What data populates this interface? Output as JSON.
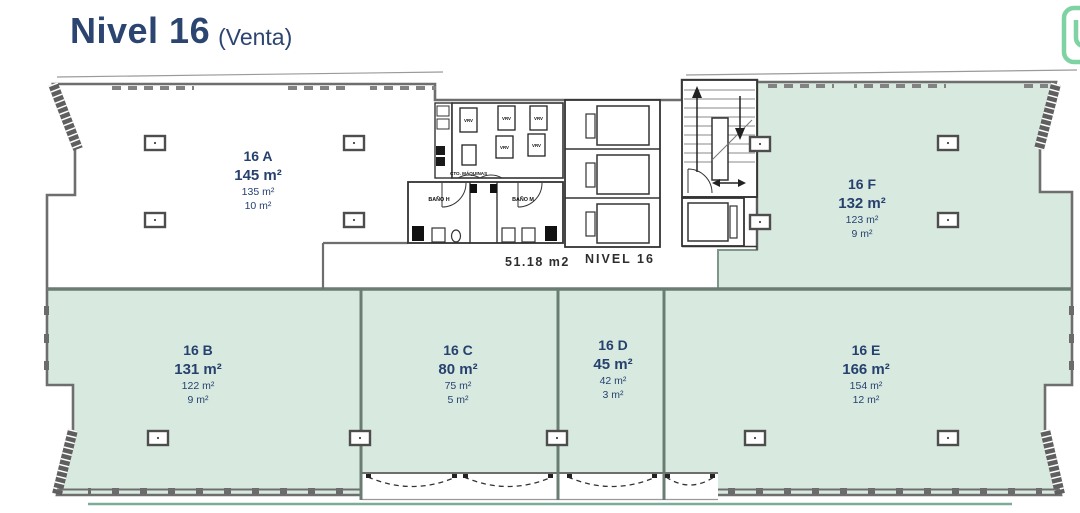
{
  "title": {
    "main": "Nivel 16",
    "suffix": "(Venta)"
  },
  "corridor": {
    "area": "51.18 m2",
    "level": "NIVEL 16"
  },
  "units": {
    "a": {
      "name": "16 A",
      "total": "145 m²",
      "sub1": "135 m²",
      "sub2": "10 m²"
    },
    "b": {
      "name": "16 B",
      "total": "131 m²",
      "sub1": "122 m²",
      "sub2": "9 m²"
    },
    "c": {
      "name": "16 C",
      "total": "80 m²",
      "sub1": "75 m²",
      "sub2": "5 m²"
    },
    "d": {
      "name": "16 D",
      "total": "45 m²",
      "sub1": "42 m²",
      "sub2": "3 m²"
    },
    "e": {
      "name": "16 E",
      "total": "166 m²",
      "sub1": "154 m²",
      "sub2": "12 m²"
    },
    "f": {
      "name": "16 F",
      "total": "132 m²",
      "sub1": "123 m²",
      "sub2": "9 m²"
    }
  },
  "core_labels": {
    "machine_room": "CTO. MÁQUINAS",
    "bath_h": "BAÑO H",
    "bath_m": "BAÑO M",
    "vrv": "VRV"
  },
  "colors": {
    "navy_text": "#2b4470",
    "unit_green_fill": "#d8eadf",
    "wall_gray": "#6e6e6e",
    "logo_green": "#7fd2a2"
  }
}
